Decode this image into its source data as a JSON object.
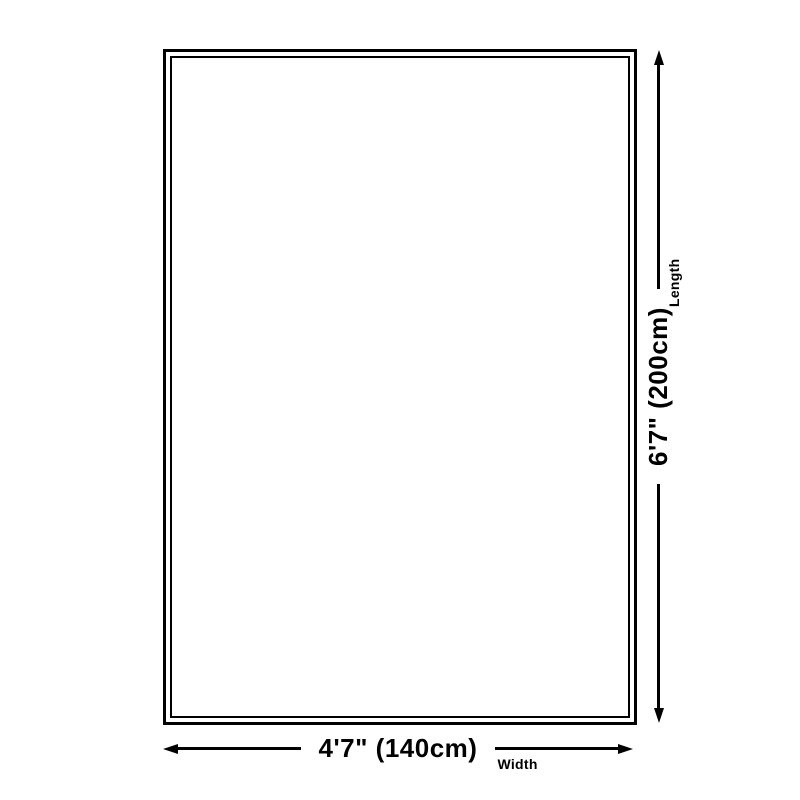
{
  "diagram": {
    "width_dimension": {
      "size": "4'7\" (140cm)",
      "axis": "Width"
    },
    "length_dimension": {
      "size": "6'7\" (200cm)",
      "axis": "Length"
    },
    "colors": {
      "line": "#000000",
      "background": "#ffffff"
    }
  }
}
